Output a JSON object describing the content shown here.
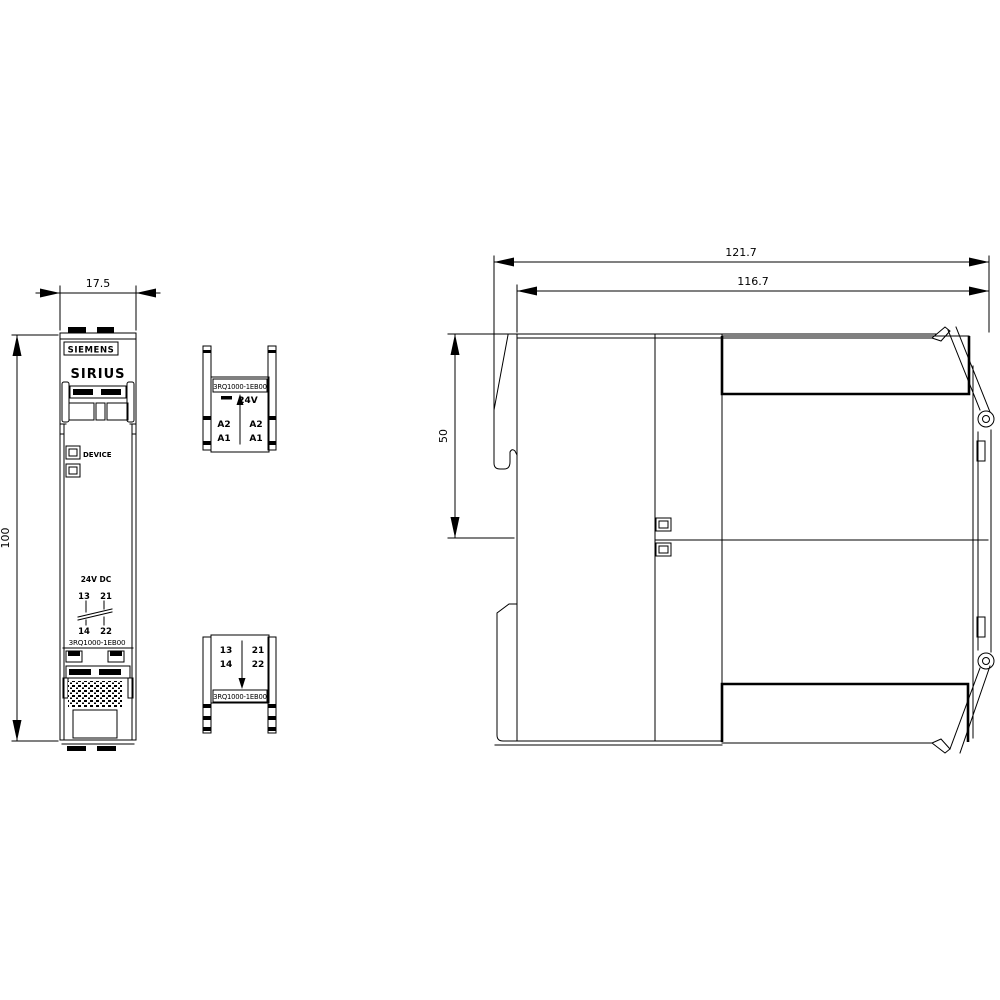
{
  "page": {
    "background": "#ffffff",
    "line_color": "#000000"
  },
  "drawing": {
    "product": {
      "brand": "SIEMENS",
      "family": "SIRIUS",
      "order_number": "3RQ1000-1EB00"
    },
    "front_view": {
      "brand": "SIEMENS",
      "family": "SIRIUS",
      "device_led_label": "DEVICE",
      "supply_label": "24V DC",
      "terminal_13": "13",
      "terminal_21": "21",
      "terminal_14": "14",
      "terminal_22": "22",
      "order_number": "3RQ1000-1EB00"
    },
    "top_view": {
      "order_number": "3RQ1000-1EB00",
      "voltage_label": "24V",
      "terminal_a2_left": "A2",
      "terminal_a2_right": "A2",
      "terminal_a1_left": "A1",
      "terminal_a1_right": "A1"
    },
    "bottom_view": {
      "order_number": "3RQ1000-1EB00",
      "terminal_13": "13",
      "terminal_21": "21",
      "terminal_14": "14",
      "terminal_22": "22"
    },
    "dimensions_mm": {
      "width": "17.5",
      "height": "100",
      "depth_total": "121.7",
      "depth_housing": "116.7",
      "depth_upper": "50"
    }
  }
}
